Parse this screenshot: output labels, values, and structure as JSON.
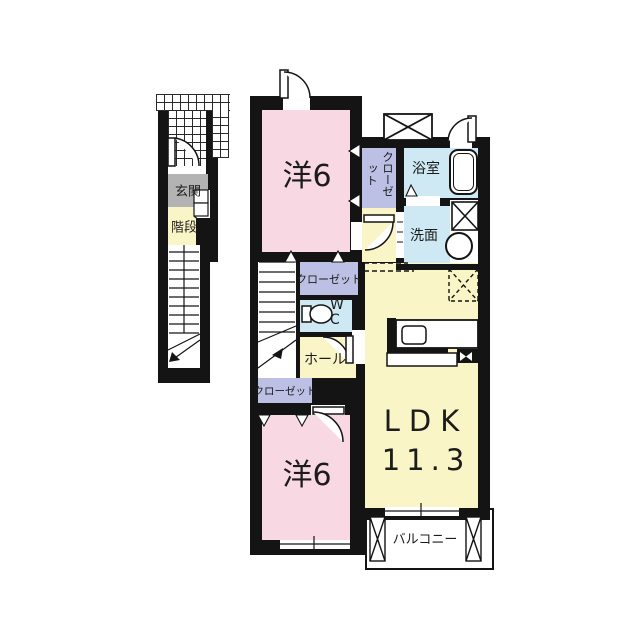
{
  "floor_plan": {
    "labels": {
      "entrance": "玄関",
      "stair_label": "階段",
      "bedroom_top": "洋6",
      "bedroom_bottom": "洋6",
      "closet_vertical": "クローゼット",
      "closet_mid": "クローゼット",
      "closet_lower": "クローゼット",
      "bath": "浴室",
      "washroom": "洗面",
      "wc_line1": "W",
      "wc_line2": "C",
      "hall": "ホール",
      "ldk_name": "LDK",
      "ldk_size": "11.3",
      "balcony": "バルコニー"
    },
    "colors": {
      "wall": "#141414",
      "bedroom_pink": "#f8d8e2",
      "living_yellow": "#faf5c6",
      "closet_lavender": "#bcc0e4",
      "wet_blue": "#cfe9f4",
      "entrance_gray": "#b3b3b3",
      "background": "#ffffff"
    }
  }
}
